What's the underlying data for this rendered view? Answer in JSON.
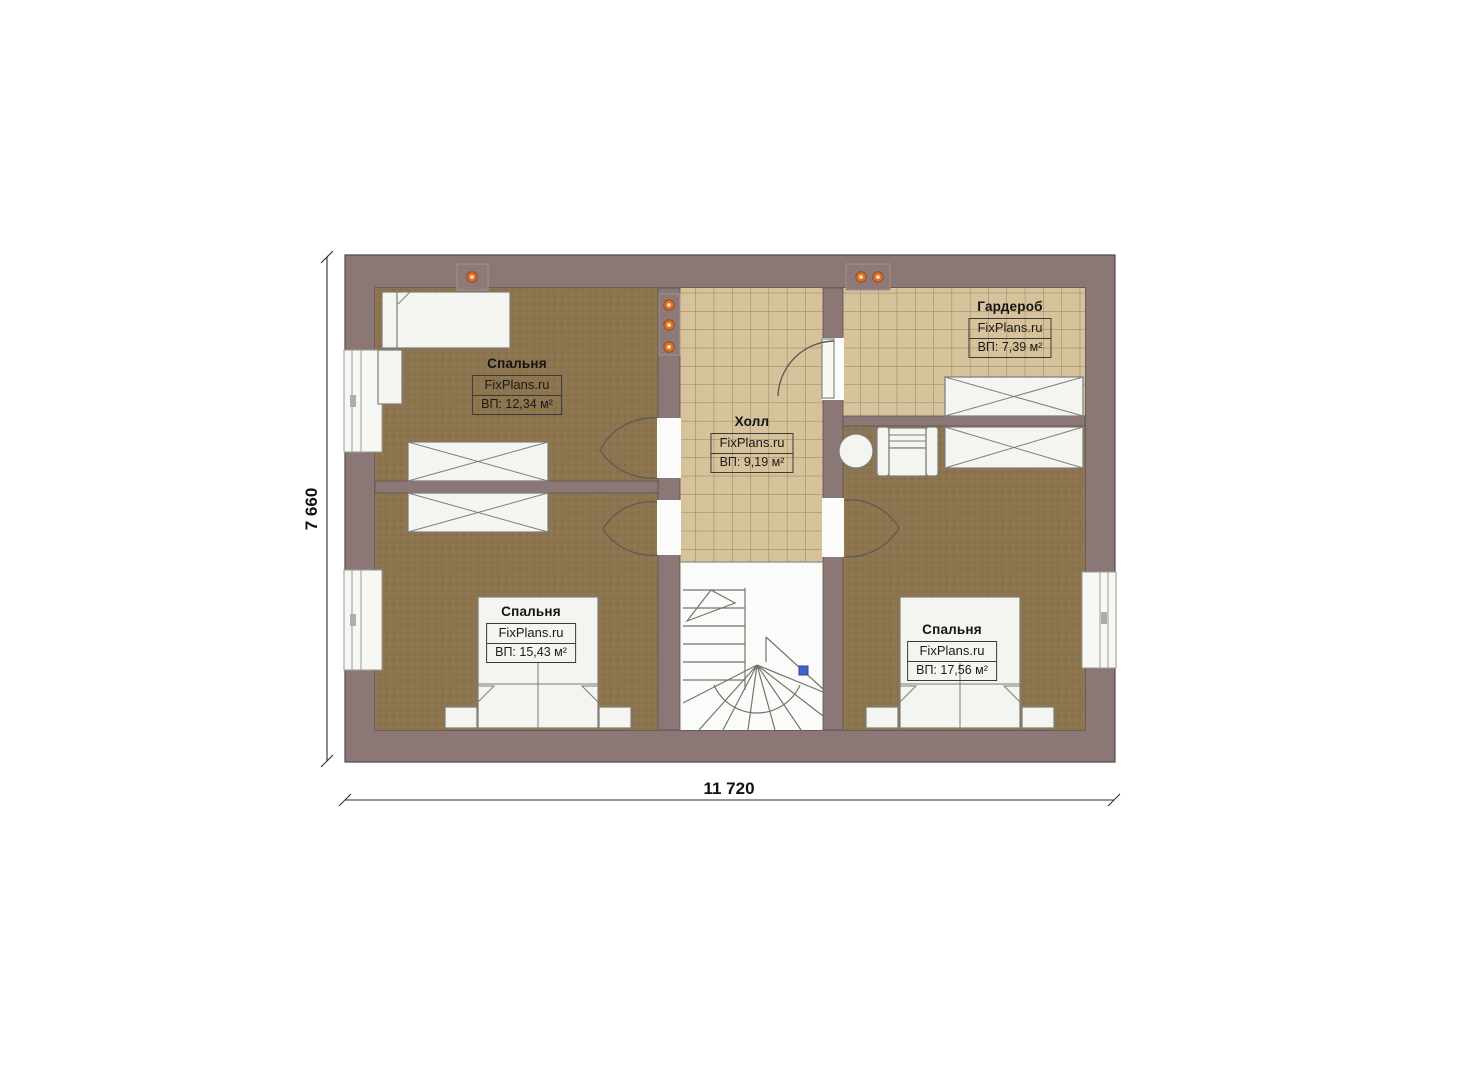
{
  "plan": {
    "rooms": [
      {
        "key": "bedroom-upper-left",
        "name": "Спальня",
        "brand": "FixPlans.ru",
        "area": "ВП: 12,34 м²"
      },
      {
        "key": "hall",
        "name": "Холл",
        "brand": "FixPlans.ru",
        "area": "ВП: 9,19 м²"
      },
      {
        "key": "wardrobe",
        "name": "Гардероб",
        "brand": "FixPlans.ru",
        "area": "ВП: 7,39 м²"
      },
      {
        "key": "bedroom-lower-left",
        "name": "Спальня",
        "brand": "FixPlans.ru",
        "area": "ВП: 15,43 м²"
      },
      {
        "key": "bedroom-lower-right",
        "name": "Спальня",
        "brand": "FixPlans.ru",
        "area": "ВП: 17,56 м²"
      }
    ],
    "dimensions": {
      "width_label": "11 720",
      "height_label": "7 660"
    },
    "colors": {
      "wall": "#8a7776",
      "wood_floor": "#8c744f",
      "tile_floor": "#d7c39b",
      "furniture": "#f4f4f1",
      "light_dot": "#dd7028",
      "stair_marker": "#3f63c8",
      "dimension_text": "#111111"
    }
  }
}
